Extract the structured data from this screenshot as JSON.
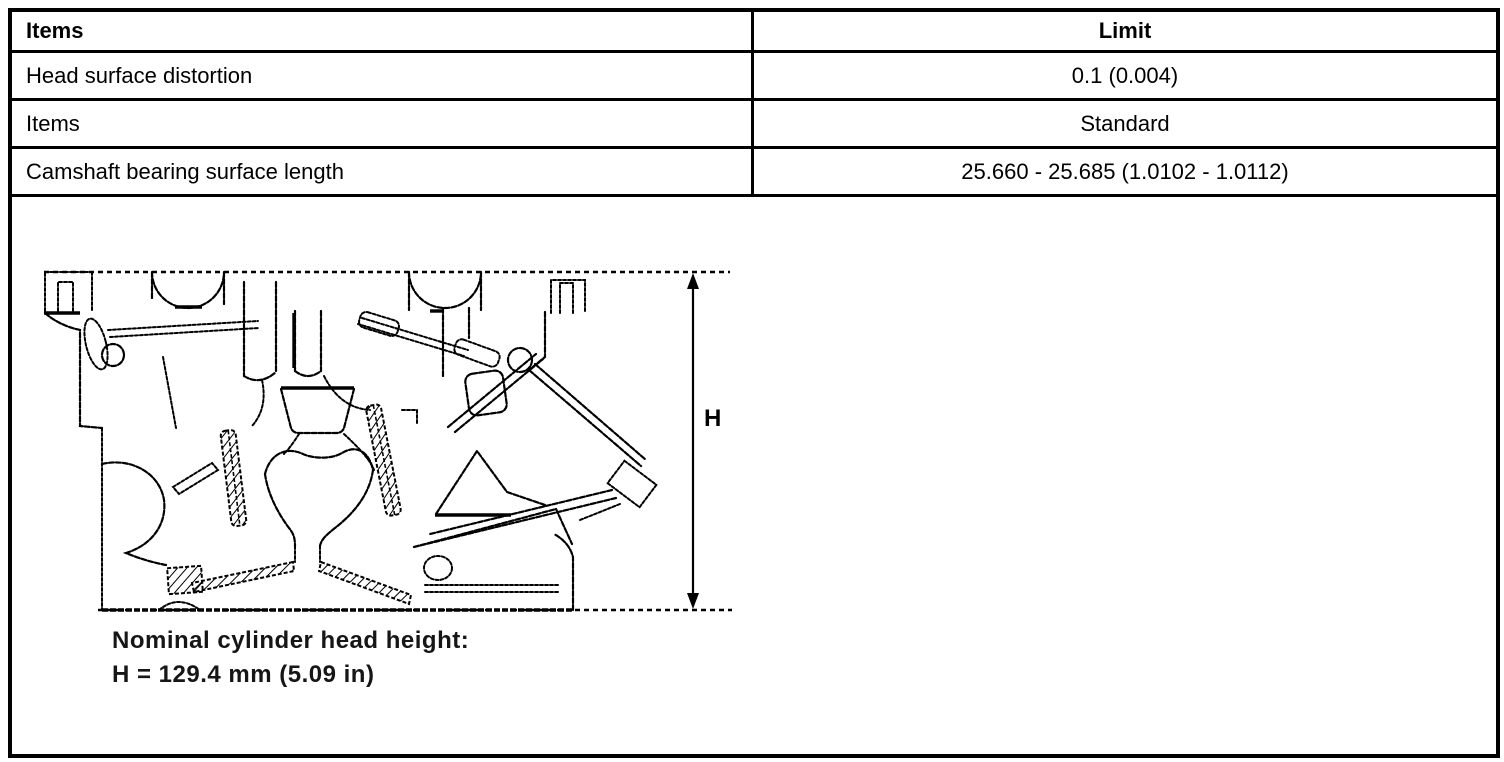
{
  "colors": {
    "ink": "#000000",
    "bg": "#ffffff"
  },
  "table": {
    "rows": [
      {
        "item": "Items",
        "value": "Limit"
      },
      {
        "item": "Head surface distortion",
        "value": "0.1 (0.004)"
      },
      {
        "item": "Items",
        "value": "Standard"
      },
      {
        "item": "Camshaft bearing surface length",
        "value": "25.660 - 25.685 (1.0102 - 1.0112)"
      }
    ]
  },
  "figure": {
    "dimension_label": "H",
    "caption_line1": "Nominal cylinder head height:",
    "caption_line2": "H = 129.4 mm (5.09 in)"
  }
}
